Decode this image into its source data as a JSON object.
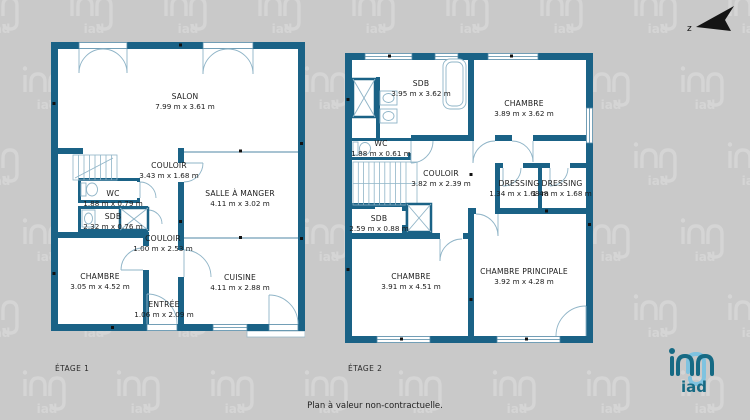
{
  "footer": {
    "note": "Plan à valeur non-contractuelle."
  },
  "compass": {
    "letter": "z"
  },
  "brand": {
    "name": "iad"
  },
  "colors": {
    "wall": "#1a6286",
    "background": "#c9c9c9",
    "thin_line": "#4f87a5",
    "brand_teal": "#166a84",
    "brand_light_blue": "#7fc3e0"
  },
  "floor1": {
    "label": "ÉTAGE 1",
    "rooms": [
      {
        "name": "SALON",
        "dims": "7.99 m x 3.61 m"
      },
      {
        "name": "COULOIR",
        "dims": "3.43 m x 1.68 m"
      },
      {
        "name": "WC",
        "dims": "1.88 m x 0.79 m"
      },
      {
        "name": "SDB",
        "dims": "2.32 m x 0.76 m"
      },
      {
        "name": "SALLE À MANGER",
        "dims": "4.11 m x 3.02 m"
      },
      {
        "name": "COULOIR",
        "dims": "1.00 m x 2.53 m"
      },
      {
        "name": "CHAMBRE",
        "dims": "3.05 m x 4.52 m"
      },
      {
        "name": "ENTRÉE",
        "dims": "1.06 m x 2.09 m"
      },
      {
        "name": "CUISINE",
        "dims": "4.11 m x 2.88 m"
      }
    ]
  },
  "floor2": {
    "label": "ÉTAGE 2",
    "rooms": [
      {
        "name": "SDB",
        "dims": "3.95 m x 3.62 m"
      },
      {
        "name": "CHAMBRE",
        "dims": "3.89 m x 3.62 m"
      },
      {
        "name": "WC",
        "dims": "1.88 m x 0.61 m"
      },
      {
        "name": "COULOIR",
        "dims": "3.82 m x 2.39 m"
      },
      {
        "name": "DRESSING",
        "dims": "1.34 m x 1.68 m"
      },
      {
        "name": "DRESSING",
        "dims": "1.48 m x 1.68 m"
      },
      {
        "name": "SDB",
        "dims": "2.59 m x 0.88 m"
      },
      {
        "name": "CHAMBRE",
        "dims": "3.91 m x 4.51 m"
      },
      {
        "name": "CHAMBRE PRINCIPALE",
        "dims": "3.92 m x 4.28 m"
      }
    ]
  }
}
